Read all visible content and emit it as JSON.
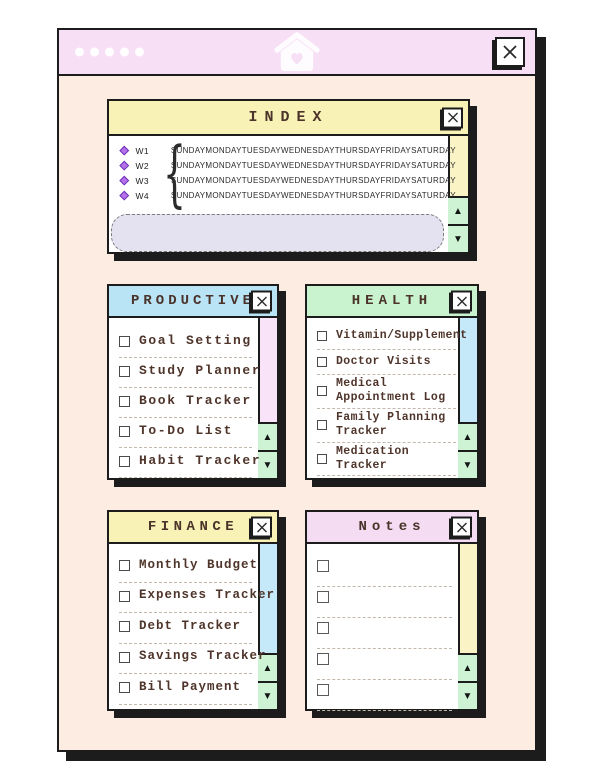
{
  "titlebar": {
    "dots": 5
  },
  "icons": {
    "up_arrow": "▲",
    "down_arrow": "▼"
  },
  "index": {
    "title": "INDEX",
    "weeks": [
      {
        "label": "W1"
      },
      {
        "label": "W2"
      },
      {
        "label": "W3"
      },
      {
        "label": "W4"
      }
    ],
    "days": [
      "SUNDAY",
      "MONDAY",
      "TUESDAY",
      "WEDNESDAY",
      "THURSDAY",
      "FRIDAY",
      "SATURDAY"
    ]
  },
  "panels": {
    "productive": {
      "title": "PRODUCTIVE",
      "items": [
        "Goal Setting",
        "Study Planner",
        "Book Tracker",
        "To-Do List",
        "Habit Tracker"
      ]
    },
    "health": {
      "title": "HEALTH",
      "items": [
        "Vitamin/Supplement",
        "Doctor Visits",
        "Medical Appointment Log",
        "Family Planning Tracker",
        "Medication Tracker"
      ]
    },
    "finance": {
      "title": "FINANCE",
      "items": [
        "Monthly Budget",
        "Expenses Tracker",
        "Debt Tracker",
        "Savings Tracker",
        "Bill Payment"
      ]
    },
    "notes": {
      "title": "Notes",
      "items": [
        "",
        "",
        "",
        "",
        ""
      ]
    }
  },
  "colors": {
    "titlebar_pink": "#f7e0f6",
    "window_body_peach": "#fcece2",
    "yellow_header": "#f9f2b6",
    "blue_header": "#b9e4f6",
    "green_header": "#c9f2cf",
    "pink_header": "#f4dcf3",
    "pink_strip": "#f8e3f8",
    "blue_strip": "#c6e9f9",
    "yellow_strip": "#f9f3c6",
    "arrow_button_green": "#cdf3d4",
    "note_box_lavender": "#e4e2f0",
    "shadow_black": "#1c1c1c",
    "text_brown": "#4e342a",
    "diamond_purple": "#b671ea"
  }
}
